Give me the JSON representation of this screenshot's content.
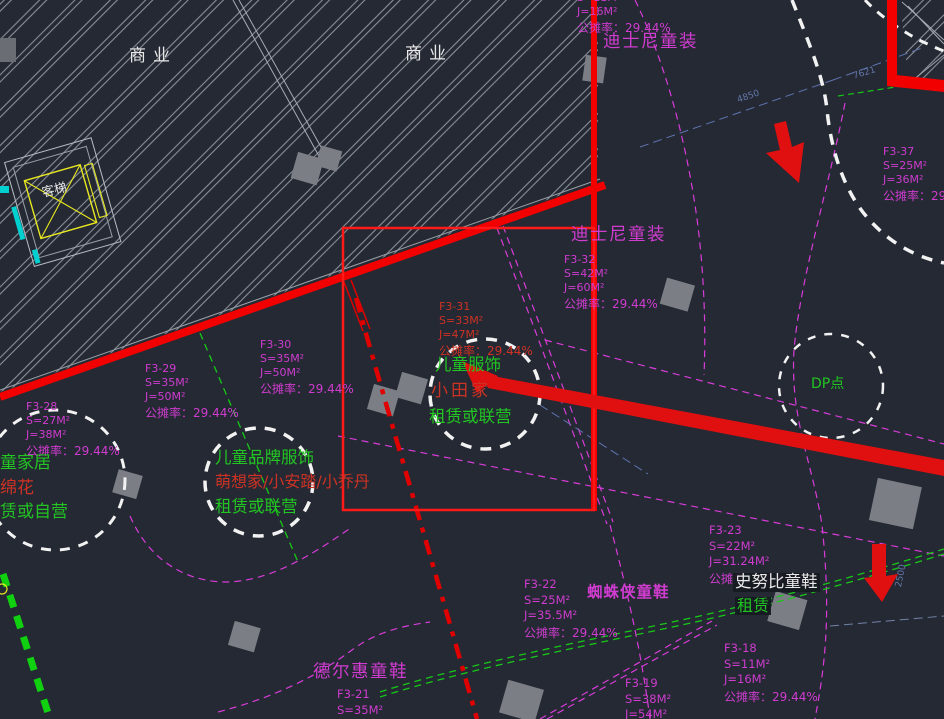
{
  "colors": {
    "background": "#242933",
    "magenta_accent": "#cf3ccf",
    "green_accent": "#22c522",
    "red_accent": "#f20000",
    "dim_blue": "#6377aa",
    "hatch_gray": "#898f99",
    "yellow": "#e8e820",
    "cyan": "#00d0d0"
  },
  "zones": {
    "commercial_1": "商业",
    "commercial_2": "商业",
    "elevator": "客梯"
  },
  "annotations": {
    "disney_top": "迪士尼童装",
    "disney_inner": "迪士尼童装",
    "kids_apparel_line1": "儿童服饰",
    "kids_apparel_line2": "小田家",
    "kids_apparel_line3": "租赁或联营",
    "kids_brand_line1": "儿童品牌服饰",
    "kids_brand_line2": "萌想家/小安踏/小乔丹",
    "kids_brand_line3": "租赁或联营",
    "home_line1": "童家居",
    "home_line2": "绵花",
    "home_line3": "赁或自营",
    "snoopy": "史努比童鞋",
    "snoopy_lease": "租赁",
    "spiderman": "蜘蛛侠童鞋",
    "deerhui": "德尔惠童鞋",
    "dp_point": "DP点"
  },
  "parcels": {
    "top_edge": {
      "area": "S=11M²",
      "gross": "J=16M²",
      "share": "公摊率：29.44%"
    },
    "f3_37": {
      "id": "F3-37",
      "area": "S=25M²",
      "gross": "J=36M²",
      "share": "公摊率：29.44%"
    },
    "f3_32": {
      "id": "F3-32",
      "area": "S=42M²",
      "gross": "J=60M²",
      "share": "公摊率：29.44%"
    },
    "f3_31": {
      "id": "F3-31",
      "area": "S=33M²",
      "gross": "J=47M²",
      "share": "公摊率：29.44%"
    },
    "f3_30": {
      "id": "F3-30",
      "area": "S=35M²",
      "gross": "J=50M²",
      "share": "公摊率：29.44%"
    },
    "f3_29": {
      "id": "F3-29",
      "area": "S=35M²",
      "gross": "J=50M²",
      "share": "公摊率：29.44%"
    },
    "f3_28": {
      "id": "F3-28",
      "area": "S=27M²",
      "gross": "J=38M²",
      "share": "公摊率：29.44%"
    },
    "f3_23": {
      "id": "F3-23",
      "area": "S=22M²",
      "gross": "J=31.24M²",
      "share": "公摊率：29.44%"
    },
    "f3_22": {
      "id": "F3-22",
      "area": "S=25M²",
      "gross": "J=35.5M²",
      "share": "公摊率：29.44%"
    },
    "f3_21": {
      "id": "F3-21",
      "area": "S=35M²",
      "gross": "J=50M²"
    },
    "f3_19": {
      "id": "F3-19",
      "area": "S=38M²",
      "gross": "J=54M²"
    },
    "f3_18": {
      "id": "F3-18",
      "area": "S=11M²",
      "gross": "J=16M²",
      "share": "公摊率：29.44%"
    }
  },
  "dimensions": {
    "d_4850": "4850",
    "d_7621": "7621",
    "d_2500": "2500"
  }
}
